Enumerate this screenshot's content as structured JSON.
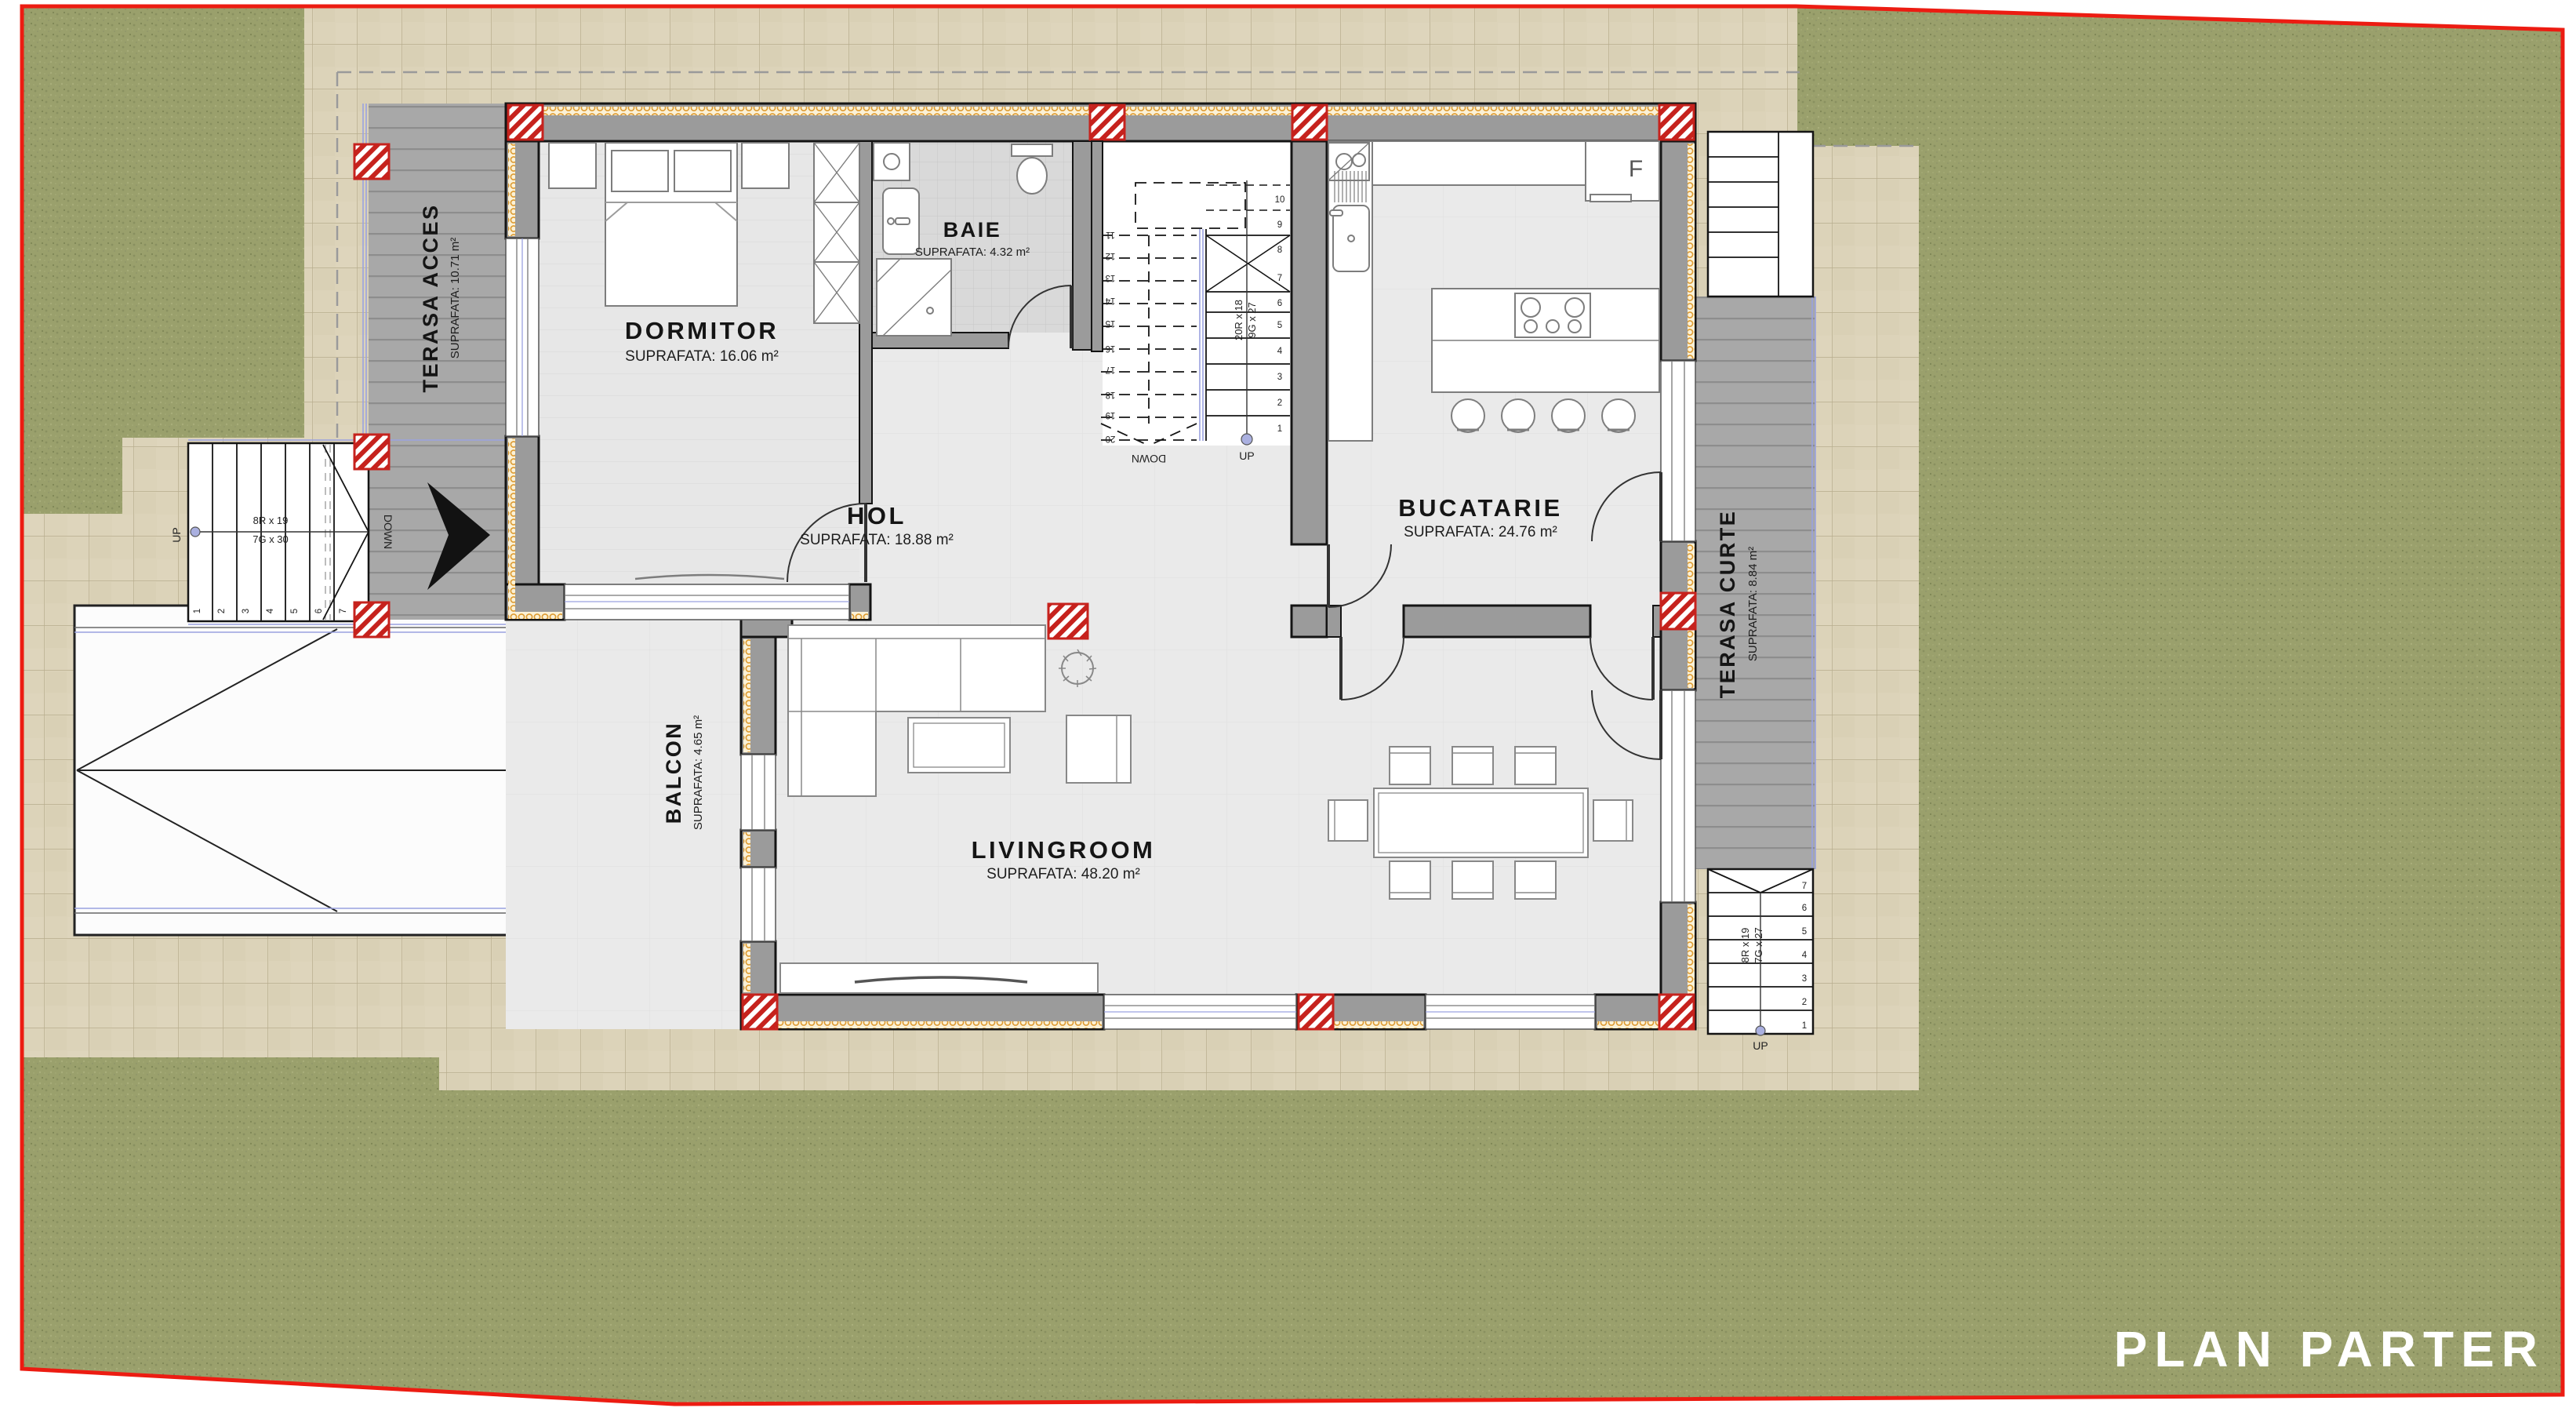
{
  "plan": {
    "logo": "PLAN PARTER",
    "rooms": {
      "dormitor": {
        "name": "DORMITOR",
        "area": "SUPRAFATA: 16.06 m²"
      },
      "baie": {
        "name": "BAIE",
        "area": "SUPRAFATA: 4.32 m²"
      },
      "hol": {
        "name": "HOL",
        "area": "SUPRAFATA: 18.88 m²"
      },
      "bucatarie": {
        "name": "BUCATARIE",
        "area": "SUPRAFATA: 24.76 m²"
      },
      "livingroom": {
        "name": "LIVINGROOM",
        "area": "SUPRAFATA: 48.20 m²"
      },
      "terasa_acces": {
        "name": "TERASA ACCES",
        "area": "SUPRAFATA: 10.71 m²"
      },
      "balcon": {
        "name": "BALCON",
        "area": "SUPRAFATA: 4.65 m²"
      },
      "terasa_curte": {
        "name": "TERASA CURTE",
        "area": "SUPRAFATA: 8.84 m²"
      }
    },
    "stairs": {
      "entry": {
        "note1": "8R x 19",
        "note2": "7G x 30",
        "up": "UP",
        "down": "DOWN",
        "steps": [
          "1",
          "2",
          "3",
          "4",
          "5",
          "6",
          "7"
        ]
      },
      "main": {
        "note1": "20R x 18",
        "note2": "9G x 27",
        "up": "UP",
        "down": "DOWN",
        "steps_up": [
          "1",
          "2",
          "3",
          "4",
          "5",
          "6",
          "7",
          "8",
          "9",
          "10"
        ],
        "steps_down": [
          "11",
          "12",
          "13",
          "14",
          "15",
          "16",
          "17",
          "18",
          "19",
          "20"
        ]
      },
      "curte": {
        "note1": "8R x 19",
        "note2": "7G x 27",
        "up": "UP",
        "steps": [
          "1",
          "2",
          "3",
          "4",
          "5",
          "6",
          "7"
        ]
      }
    },
    "kitchen": {
      "fridge_label": "F"
    },
    "colors": {
      "boundary": "#ec1c12",
      "grass": "#9aa06c",
      "paving": "#dcd3b9",
      "deck": "#a8a8a8",
      "wall": "#9b9b9b",
      "insulation": "#dd9a30",
      "column_hatch": "#c6221d",
      "interior_floor": "#eaeaea"
    }
  }
}
